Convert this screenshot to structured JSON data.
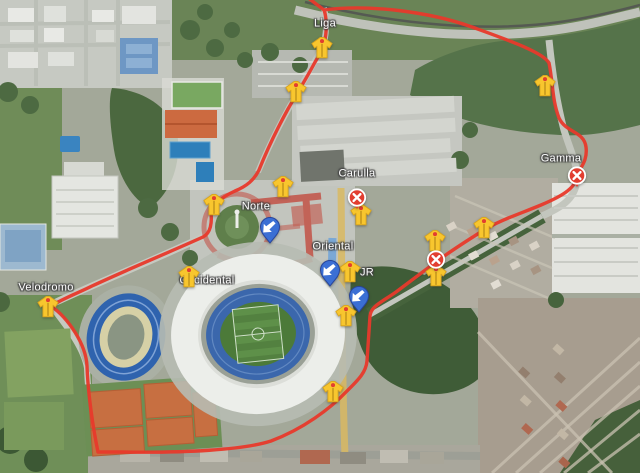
{
  "map": {
    "kind": "satellite-route-map",
    "route": {
      "label": "course-route",
      "color": "#e8392b",
      "path": "M 307 -3 L 324 10 C 370 4 430 12 472 27 C 505 39 543 52 549 63 C 553 82 552 100 559 118 C 566 133 584 131 586 147 C 588 163 578 169 577 177 C 575 189 560 197 541 205 C 522 213 500 220 484 230 C 468 240 452 250 436 262 C 420 274 408 283 396 292 C 382 302 371 306 370 316 C 369 332 368 348 367 361 C 366 373 357 381 347 391 C 330 409 303 429 271 441 C 243 450 185 453 121 452 L 98 452 C 93 428 88 394 87 366 C 86 344 68 318 51 306 C 62 299 78 293 92 286 C 131 268 172 251 203 237 C 211 233 212 222 211 213 C 213 203 224 196 235 191 C 247 186 254 180 259 170 C 267 150 277 129 288 109 C 296 95 306 79 314 64 C 319 55 323 50 324 44 C 327 33 327 18 324 10"
    },
    "labels": [
      {
        "text": "Liga",
        "x": 325,
        "y": 24
      },
      {
        "text": "Carulla",
        "x": 357,
        "y": 174
      },
      {
        "text": "Gamma",
        "x": 561,
        "y": 159
      },
      {
        "text": "Norte",
        "x": 256,
        "y": 207
      },
      {
        "text": "Oriental",
        "x": 333,
        "y": 247
      },
      {
        "text": "JR",
        "x": 367,
        "y": 273
      },
      {
        "text": "Occidental",
        "x": 207,
        "y": 281
      },
      {
        "text": "Velodromo",
        "x": 46,
        "y": 288
      }
    ],
    "markers": {
      "staff": {
        "icon": "vest-marker-icon",
        "color": "#f8c62e",
        "points": [
          [
            322,
            49
          ],
          [
            296,
            93
          ],
          [
            545,
            87
          ],
          [
            283,
            188
          ],
          [
            214,
            206
          ],
          [
            361,
            216
          ],
          [
            484,
            229
          ],
          [
            435,
            242
          ],
          [
            350,
            273
          ],
          [
            436,
            277
          ],
          [
            189,
            278
          ],
          [
            48,
            308
          ],
          [
            346,
            317
          ],
          [
            333,
            393
          ]
        ]
      },
      "closed": {
        "icon": "road-closed-x-icon",
        "color": "#e23e30",
        "points": [
          [
            357,
            199
          ],
          [
            436,
            261
          ],
          [
            577,
            177
          ]
        ]
      },
      "direction": {
        "icon": "arrow-southwest-pin-icon",
        "color": "#3b6fd4",
        "points": [
          [
            270,
            231
          ],
          [
            330,
            274
          ],
          [
            359,
            300
          ]
        ]
      }
    }
  }
}
